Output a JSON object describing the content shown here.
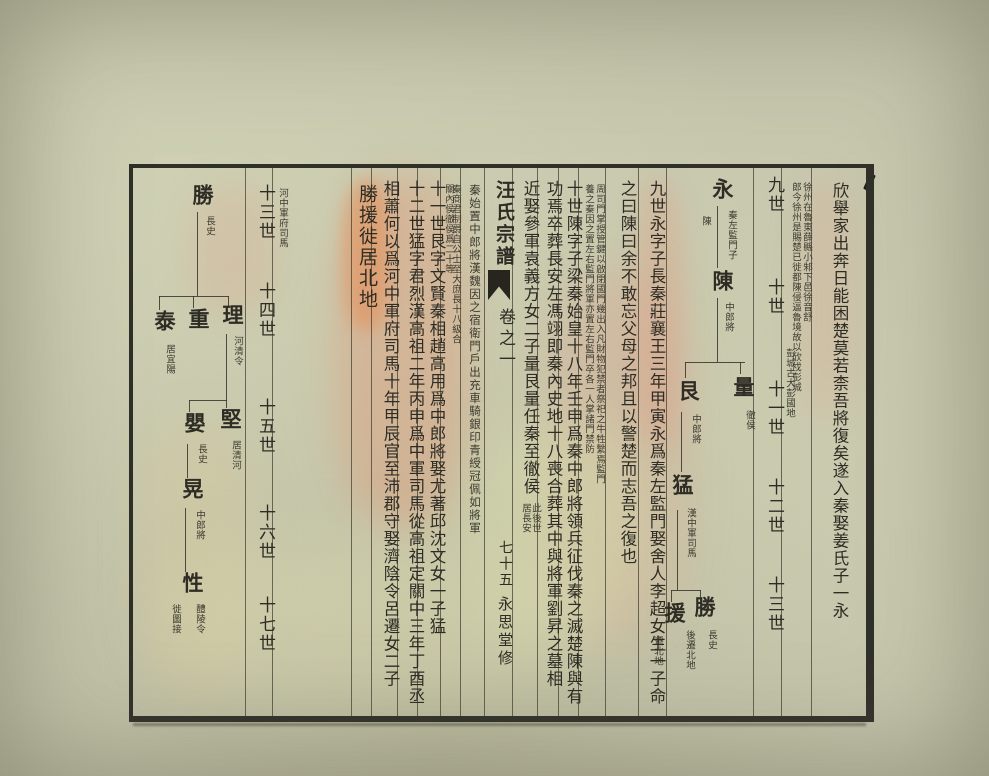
{
  "book": {
    "title": "汪氏宗譜",
    "volume": "卷之一",
    "page_number": "七十五",
    "hall": "永思堂修"
  },
  "colors": {
    "paper": "#c6c7ae",
    "ink": "#2e2d25",
    "border": "#30302a",
    "stain_pink": "#e2947c",
    "stain_salmon": "#e88a4e"
  },
  "right_page": {
    "generations": [
      "九世",
      "十世",
      "十一世",
      "十二世",
      "十三世"
    ],
    "main_text": {
      "c1": "欣舉家出奔日能困楚莫若柰吾將復矣遂入秦娶姜氏子一永",
      "c2": "九世永字子長秦莊襄王三年甲寅永爲秦左監門娶舍人李超女生一子命",
      "c3": "之曰陳曰余不敢忘父母之邦且以警楚而志吾之復也",
      "c4": "十世陳字子梁秦始皇十八年壬申爲秦中郎將領兵征伐秦之滅楚陳與有",
      "c5": "功焉卒葬長安左馮翊即秦內史地十八喪合葬其中與將軍劉昇之墓相",
      "c6": "近娶參軍袁義方女二子量艮量任秦至徹侯"
    },
    "notes": {
      "xuzhou_1": "徐州在魯東薛縣小邾下邑徐音舒",
      "xuzhou_2": "郎今徐州是賜楚已徙都陳侵逼魯境故以欣戍彭城",
      "xuzhou_3": "彭城古大彭國地",
      "simen_1": "周司門掌授管鍵以啟閉國門幾出入凡財物犯禁者祭祀之牛牲繫焉監門",
      "simen_2": "養之秦因之置左右監門將軍亦置左右監門卒各一人掌諸門禁防",
      "residence_1": "此後世",
      "residence_2": "居長安"
    },
    "tree": {
      "yong": {
        "name": "永",
        "note_r": "秦左監門子",
        "note_l": "陳"
      },
      "chen": {
        "name": "陳",
        "note": "中郎將"
      },
      "liang": {
        "name": "量",
        "note": "徹侯"
      },
      "gen": {
        "name": "艮",
        "note": "中郎將"
      },
      "meng": {
        "name": "猛",
        "note": "漢中軍司馬"
      },
      "sheng": {
        "name": "勝",
        "note_r": "長史",
        "note_l": "後遷北地"
      },
      "yuan": {
        "name": "援",
        "note": "遷北地"
      }
    }
  },
  "left_page": {
    "generations": [
      "十三世",
      "十四世",
      "十五世",
      "十六世",
      "十七世"
    ],
    "main_text": {
      "c1": "十一世艮字文賢秦相趙高用爲中郎將娶尤著邱沈文女一子猛",
      "c2": "十二世猛字君烈漢高祖二年丙申爲中軍司馬從高祖定關中三年丁酉丞",
      "c3": "相蕭何以爲河中軍府司馬十年甲辰官至沛郡守娶濟陰令呂遷女二子",
      "highlight": "勝援徙居北地"
    },
    "notes": {
      "zhonglangjiang": "秦始置中郎將漢魏因之宿衛門戶出充車騎銀印青綬冠佩如將軍",
      "chehou_1": "秦商君制爵自公士至大庶長十八級合",
      "chehou_2": "關內侯徹侯爲二十等",
      "sima": "河中軍府司馬"
    },
    "tree": {
      "sheng": {
        "name": "勝",
        "note": "長史"
      },
      "li": {
        "name": "理",
        "note": "河清令"
      },
      "zhong": {
        "name": "重"
      },
      "tai": {
        "name": "泰",
        "note": "居宜陽"
      },
      "jian": {
        "name": "堅",
        "note": "居清河"
      },
      "ying": {
        "name": "嬰",
        "note": "長史"
      },
      "huang": {
        "name": "晃",
        "note": "中郎將"
      },
      "xing": {
        "name": "性",
        "note_r": "醴陵令",
        "note_l": "徙圖接"
      }
    }
  }
}
